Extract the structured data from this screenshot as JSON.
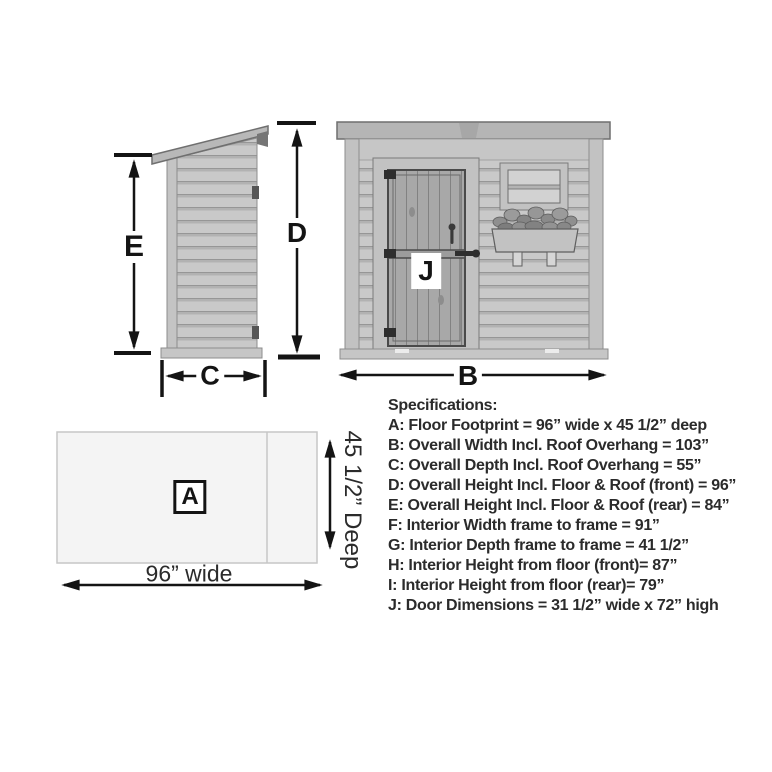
{
  "diagram": {
    "labels": {
      "a": "A",
      "b": "B",
      "c": "C",
      "d": "D",
      "e": "E",
      "j": "J"
    },
    "floor_plan": {
      "width_label": "96” wide",
      "depth_label": "45 1/2” Deep"
    }
  },
  "specifications": {
    "title": "Specifications:",
    "items": [
      "A: Floor Footprint = 96” wide x 45 1/2” deep",
      "B: Overall Width Incl. Roof Overhang = 103”",
      "C: Overall Depth Incl. Roof Overhang = 55”",
      "D: Overall Height Incl. Floor & Roof (front) = 96”",
      "E: Overall Height Incl. Floor & Roof (rear) = 84”",
      "F: Interior Width frame to frame = 91”",
      "G: Interior Depth frame to frame = 41 1/2”",
      "H: Interior Height from floor (front)= 87”",
      "I: Interior Height from floor (rear)= 79”",
      "J: Door Dimensions = 31 1/2” wide x 72” high"
    ]
  },
  "colors": {
    "background": "#ffffff",
    "line_art": "#141414",
    "text": "#2b2b2b",
    "siding_gray": "#c9c9c9",
    "trim_gray": "#c2c2c2",
    "door_gray": "#a8a8a8",
    "floor_plan_fill": "#f4f4f4",
    "floor_plan_border": "#c6c6c6"
  }
}
